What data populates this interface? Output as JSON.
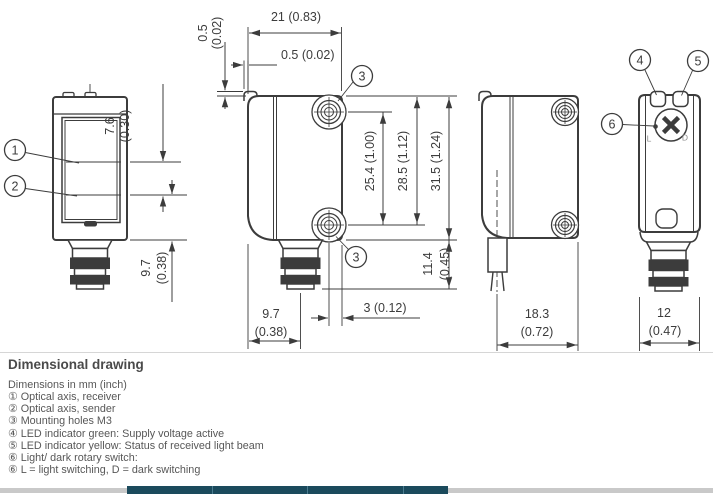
{
  "section_title": "Dimensional drawing",
  "units_note": "Dimensions in mm (inch)",
  "legend": [
    {
      "num": "①",
      "text": "Optical axis, receiver"
    },
    {
      "num": "②",
      "text": "Optical axis, sender"
    },
    {
      "num": "③",
      "text": "Mounting holes M3"
    },
    {
      "num": "④",
      "text": "LED indicator green: Supply voltage active"
    },
    {
      "num": "⑤",
      "text": "LED indicator yellow: Status of received light beam"
    },
    {
      "num": "⑥",
      "text": "Light/ dark rotary switch:"
    },
    {
      "num": "⑥",
      "text": "L = light switching, D = dark switching"
    }
  ],
  "callouts": {
    "optical_axis_receiver": "1",
    "optical_axis_sender": "2",
    "mounting_holes": "3",
    "led_green": "4",
    "led_yellow": "5",
    "rotary_switch": "6"
  },
  "dimensions": {
    "housing_width_top": {
      "label": "21 (0.83)"
    },
    "lens_offset_front": {
      "label": "0.5 (0.02)"
    },
    "lens_offset_top": {
      "mm": "0.5",
      "inch": "(0.02)"
    },
    "axis_spacing": {
      "mm": "7.6",
      "inch": "(0.30)"
    },
    "axis_to_bottom": {
      "mm": "9.7",
      "inch": "(0.38)"
    },
    "hole_spacing": {
      "label": "25.4 (1.00)"
    },
    "top_to_bottom_hole": {
      "label": "28.5 (1.12)"
    },
    "housing_height": {
      "label": "31.5 (1.24)"
    },
    "connector_length": {
      "mm": "11.4",
      "inch": "(0.45)"
    },
    "front_to_connector_axis": {
      "mm": "9.7",
      "inch": "(0.38)"
    },
    "hole_to_rear": {
      "label": "3 (0.12)"
    },
    "cable_housing_depth": {
      "mm": "18.3",
      "inch": "(0.72)"
    },
    "housing_thickness": {
      "mm": "12",
      "inch": "(0.47)"
    }
  },
  "switch_labels": {
    "light": "L",
    "dark": "D"
  },
  "colors": {
    "line": "#3c3c3c",
    "text": "#575757",
    "accent_bar": "#1b4a5c",
    "footer_bar": "#c9c9c9"
  }
}
